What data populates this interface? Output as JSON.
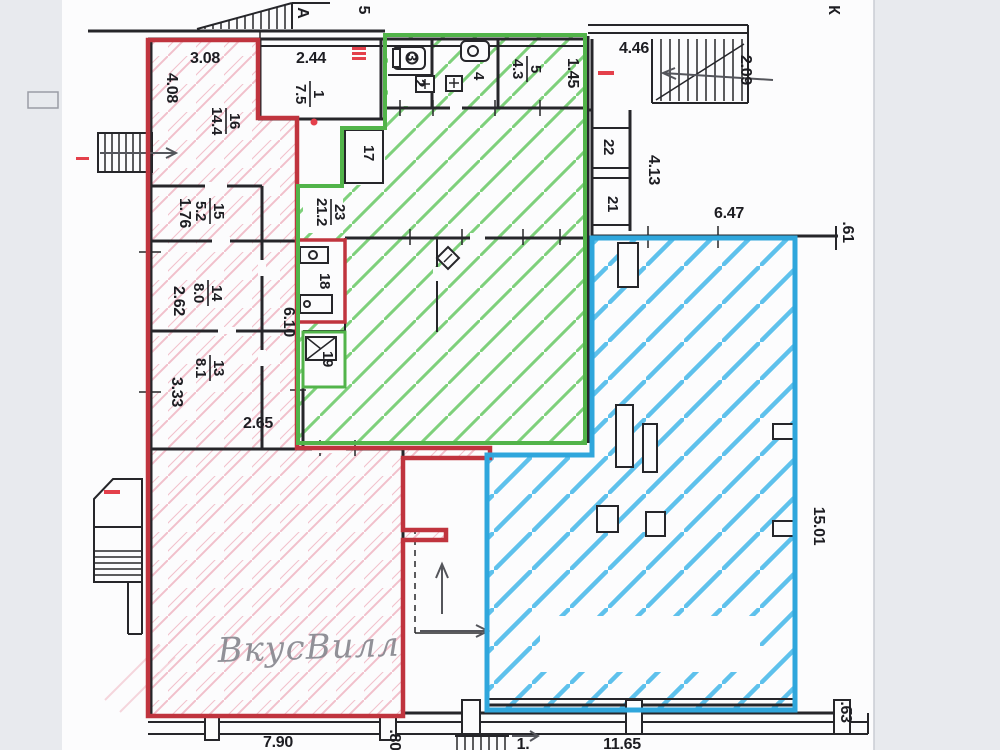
{
  "document_kind": "scanned floor plan with colored zone markup",
  "colors": {
    "red_outline": "#c0343e",
    "pink_hatch": "#f1c0cb",
    "green_outline": "#52b44a",
    "green_hatch": "#7ed07b",
    "blue_outline": "#2fa6dc",
    "blue_hatch": "#5ec1ec",
    "wall": "#26262a",
    "paper": "#fcfcfd",
    "margin": "#e8eaee",
    "pencil": "#86868e",
    "mark_red": "#e4404b"
  },
  "handwriting": {
    "text": "ВкусВилл"
  },
  "axis_letters": [
    {
      "text": "А",
      "x": 298,
      "y": 13,
      "rot": 90
    },
    {
      "text": "5",
      "x": 359,
      "y": 10,
      "rot": 90
    },
    {
      "text": "К",
      "x": 829,
      "y": 10,
      "rot": 90
    }
  ],
  "dimensions": [
    {
      "text": "3.08",
      "x": 205,
      "y": 63
    },
    {
      "text": "2.44",
      "x": 311,
      "y": 63
    },
    {
      "text": "4.46",
      "x": 634,
      "y": 53
    },
    {
      "text": "6.47",
      "x": 729,
      "y": 218
    },
    {
      "text": "2.65",
      "x": 258,
      "y": 428
    },
    {
      "text": "7.90",
      "x": 278,
      "y": 747
    },
    {
      "text": "11.65",
      "x": 622,
      "y": 749
    },
    {
      "text": "1.",
      "x": 523,
      "y": 749
    },
    {
      "text": "4.08",
      "x": 167,
      "y": 88,
      "rot": 90
    },
    {
      "text": "1.76",
      "x": 180,
      "y": 213,
      "rot": 90
    },
    {
      "text": "2.62",
      "x": 174,
      "y": 301,
      "rot": 90
    },
    {
      "text": "3.33",
      "x": 172,
      "y": 392,
      "rot": 90
    },
    {
      "text": "6.10",
      "x": 284,
      "y": 322,
      "rot": 90
    },
    {
      "text": "1.45",
      "x": 568,
      "y": 73,
      "rot": 90
    },
    {
      "text": "2.09",
      "x": 741,
      "y": 70,
      "rot": 90
    },
    {
      "text": "4.13",
      "x": 649,
      "y": 170,
      "rot": 90
    },
    {
      "text": ".61",
      "x": 843,
      "y": 232,
      "rot": 90
    },
    {
      "text": "15.01",
      "x": 814,
      "y": 526,
      "rot": 90
    },
    {
      "text": ".63",
      "x": 841,
      "y": 712,
      "rot": 90
    },
    {
      "text": ".80",
      "x": 390,
      "y": 740,
      "rot": 90
    }
  ],
  "room_labels": [
    {
      "number": "16",
      "area": "14.4",
      "x": 226,
      "y": 121
    },
    {
      "number": "1",
      "area": "7.5",
      "x": 310,
      "y": 94
    },
    {
      "number": "15",
      "area": "5.2",
      "x": 210,
      "y": 211
    },
    {
      "number": "14",
      "area": "8.0",
      "x": 208,
      "y": 293
    },
    {
      "number": "13",
      "area": "8.1",
      "x": 210,
      "y": 368
    },
    {
      "number": "23",
      "area": "21.2",
      "x": 331,
      "y": 212
    },
    {
      "number": "5",
      "area": "4.3",
      "x": 527,
      "y": 69
    }
  ],
  "room_numbers": [
    {
      "text": "17",
      "x": 364,
      "y": 153,
      "rot": 90
    },
    {
      "text": "18",
      "x": 320,
      "y": 281,
      "rot": 90
    },
    {
      "text": "19",
      "x": 323,
      "y": 359,
      "rot": 90
    },
    {
      "text": "22",
      "x": 604,
      "y": 147,
      "rot": 90
    },
    {
      "text": "21",
      "x": 608,
      "y": 204,
      "rot": 90
    },
    {
      "text": "2",
      "x": 415,
      "y": 83,
      "rot": 90
    },
    {
      "text": "3",
      "x": 407,
      "y": 57,
      "rot": 90
    },
    {
      "text": "4",
      "x": 474,
      "y": 76,
      "rot": 90
    }
  ]
}
